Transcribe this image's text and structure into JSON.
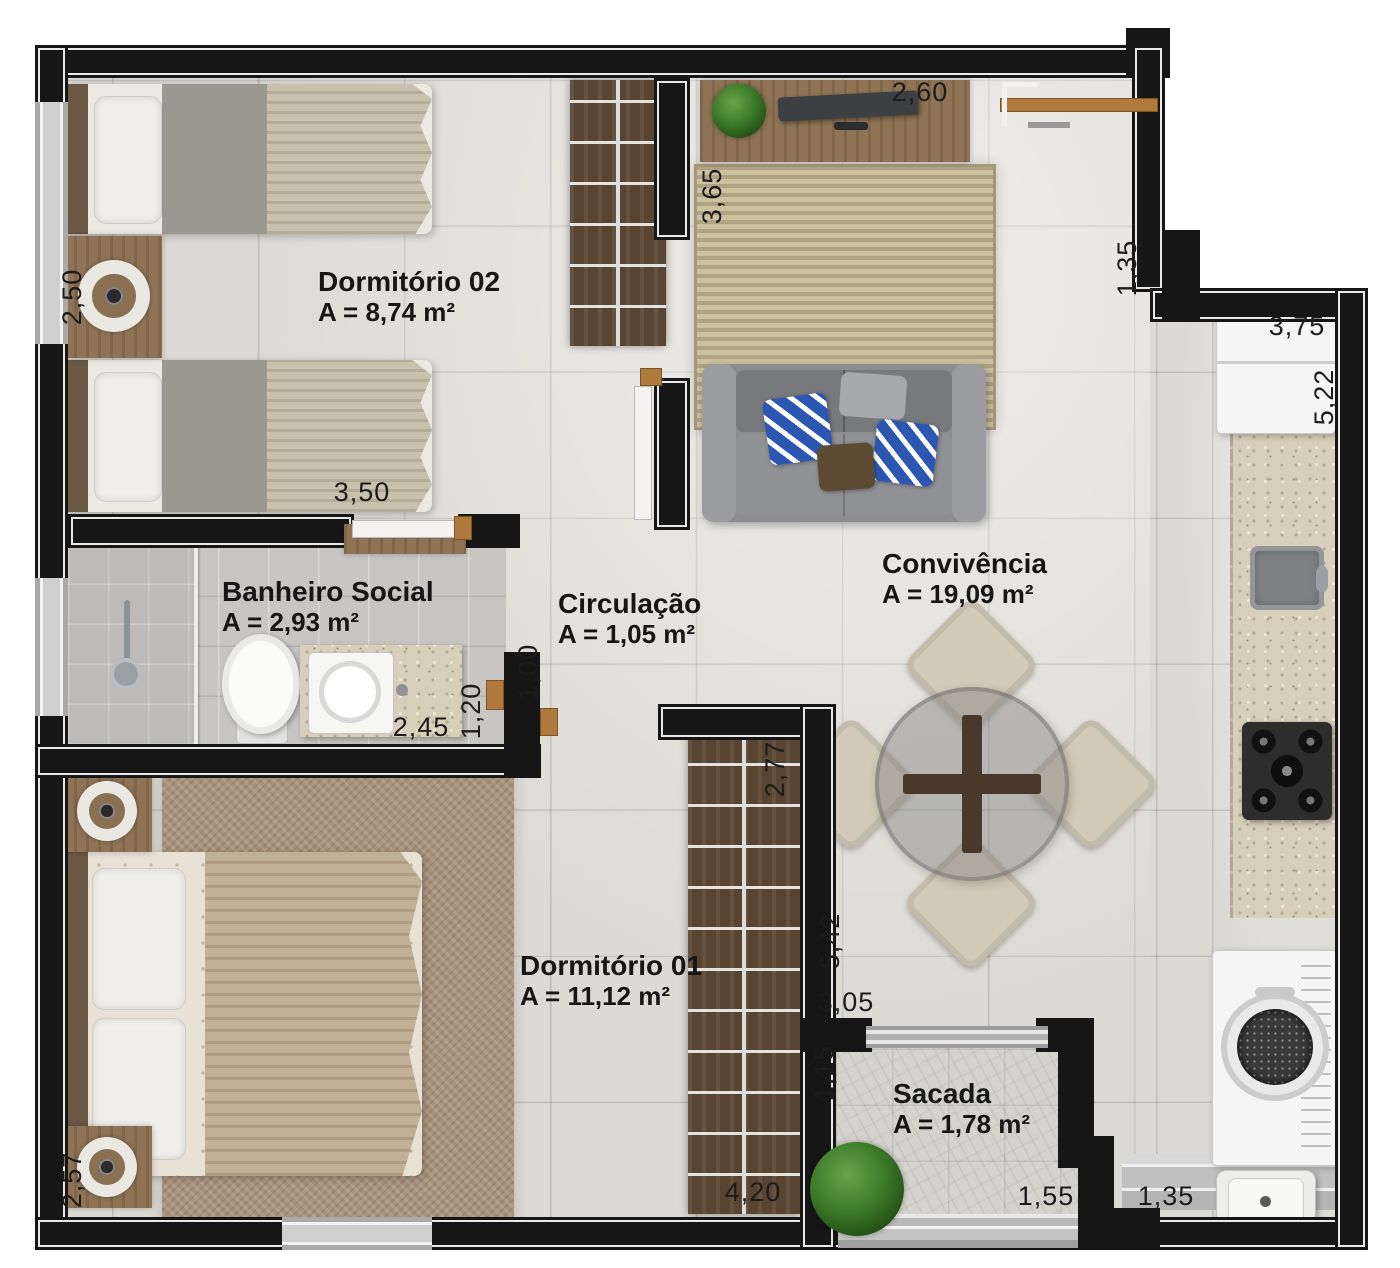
{
  "plan_title": "Apartment floor plan",
  "rooms": [
    {
      "id": "dormitorio-02",
      "name": "Dormitório 02",
      "area": "A = 8,74 m²"
    },
    {
      "id": "banheiro-social",
      "name": "Banheiro Social",
      "area": "A = 2,93 m²"
    },
    {
      "id": "circulacao",
      "name": "Circulação",
      "area": "A = 1,05 m²"
    },
    {
      "id": "convivencia",
      "name": "Convivência",
      "area": "A = 19,09 m²"
    },
    {
      "id": "dormitorio-01",
      "name": "Dormitório 01",
      "area": "A = 11,12 m²"
    },
    {
      "id": "sacada",
      "name": "Sacada",
      "area": "A = 1,78 m²"
    }
  ],
  "dimensions": {
    "dorm02_left": "2,50",
    "dorm02_bottom": "3,50",
    "tv_wall": "2,60",
    "rug_side": "3,65",
    "kitchen_entry": "1,35",
    "kitchen_top": "3,75",
    "kitchen_right": "5,22",
    "circulation_wall": "1,00",
    "bath_right": "1,20",
    "bath_bottom": "2,45",
    "wardrobe01_side": "2,77",
    "dorm01_right": "5,42",
    "dorm01_bottom": "3,05",
    "sacada_left": "1,15",
    "wardrobe01_bottom": "4,20",
    "sacada_bottom": "1,55",
    "laundry_bottom": "1,35",
    "dorm01_left": "2,57"
  },
  "colors": {
    "wall": "#161616",
    "floor": "#dcdad4",
    "wood_dark": "#584430",
    "wood_medium": "#8f7354",
    "sofa_grey": "#8b8d91",
    "pillow_blue": "#2b57b3",
    "rug_living": "#c3b697",
    "rug_bedroom": "#a8927b",
    "granite": "#d8cfba"
  }
}
